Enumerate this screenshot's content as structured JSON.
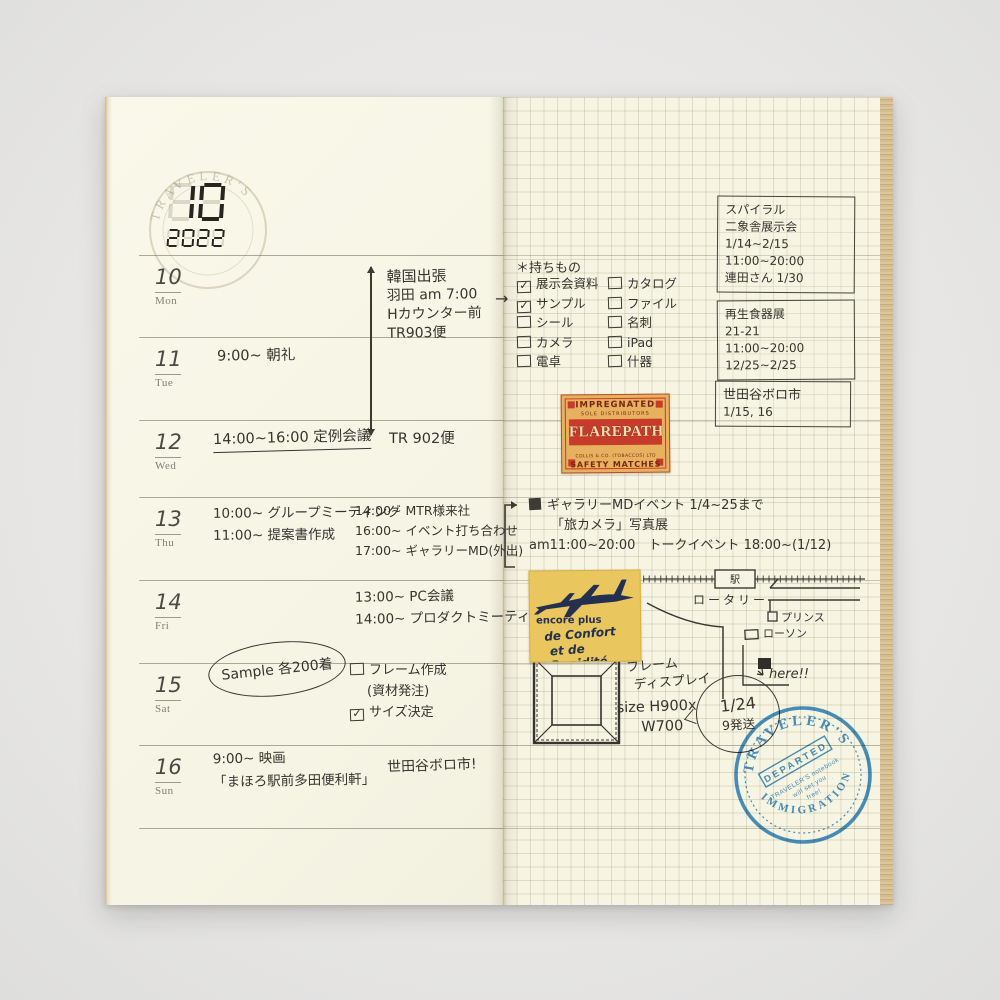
{
  "colors": {
    "ink": "#35342e",
    "printed_gray": "#80807a",
    "paper_left": "#f7f5e6",
    "paper_right": "#f6f4e3",
    "stamp_blue": "#2f83c5",
    "match_bg": "#e7b25f",
    "match_red": "#c63b2a",
    "sticker_yellow": "#eac75e",
    "sticker_navy": "#233050"
  },
  "header": {
    "month": "10",
    "year": "2022",
    "watermark": "TRAVELER'S"
  },
  "week": [
    {
      "date": "10",
      "day": "Mon",
      "plan": [
        "韓国出張",
        "羽田 am 7:00",
        "Hカウンター前",
        "TR903便"
      ],
      "arrow_note": "TR 902便"
    },
    {
      "date": "11",
      "day": "Tue",
      "plan": [
        "9:00~ 朝礼"
      ]
    },
    {
      "date": "12",
      "day": "Wed",
      "plan": [
        "14:00~16:00 定例会議"
      ]
    },
    {
      "date": "13",
      "day": "Thu",
      "plan": [
        "10:00~ グループミーティング",
        "11:00~ 提案書作成"
      ],
      "plan2": [
        "14:00~ MTR様来社",
        "16:00~ イベント打ち合わせ",
        "17:00~ ギャラリーMD(外出)"
      ]
    },
    {
      "date": "14",
      "day": "Fri",
      "plan2": [
        "13:00~ PC会議",
        "14:00~ プロダクトミーティング"
      ]
    },
    {
      "date": "15",
      "day": "Sat",
      "circled": "Sample 各200着",
      "tasks": [
        {
          "check": "",
          "label": "フレーム作成"
        },
        {
          "check": "",
          "label": "(資材発注)"
        },
        {
          "check": "✓",
          "label": "サイズ決定"
        }
      ]
    },
    {
      "date": "16",
      "day": "Sun",
      "plan": [
        "9:00~ 映画",
        "「まほろ駅前多田便利軒」"
      ],
      "note": "世田谷ボロ市!"
    }
  ],
  "memo": {
    "arrow": "→",
    "packing": {
      "title": "＊持ちもの",
      "col1": [
        {
          "check": "✓",
          "label": "展示会資料"
        },
        {
          "check": "✓",
          "label": "サンプル"
        },
        {
          "check": "",
          "label": "シール"
        },
        {
          "check": "",
          "label": "カメラ"
        },
        {
          "check": "",
          "label": "電卓"
        }
      ],
      "col2": [
        {
          "check": "",
          "label": "カタログ"
        },
        {
          "check": "",
          "label": "ファイル"
        },
        {
          "check": "",
          "label": "名刺"
        },
        {
          "check": "",
          "label": "iPad"
        },
        {
          "check": "",
          "label": "什器"
        }
      ]
    },
    "boxes": [
      {
        "lines": [
          "スパイラル",
          "二象舎展示会",
          "1/14~2/15",
          "11:00~20:00",
          "連田さん 1/30"
        ]
      },
      {
        "lines": [
          "再生食器展",
          "21-21",
          "11:00~20:00",
          "12/25~2/25"
        ]
      },
      {
        "lines": [
          "世田谷ボロ市",
          "1/15, 16"
        ]
      }
    ],
    "gallery": {
      "line1": "ギャラリーMDイベント 1/4~25まで",
      "line2": "「旅カメラ」写真展",
      "line3": "am11:00~20:00　トークイベント 18:00~(1/12)"
    },
    "map": {
      "station": "駅",
      "rotary": "ロータリー",
      "prince": "プリンス",
      "lawson": "ローソン",
      "here": "here!!"
    },
    "frame": {
      "title1": "フレーム",
      "title2": "ディスプレイ",
      "size1": "size H900x",
      "size2": "W700",
      "bubble1": "1/24",
      "bubble2": "9発送"
    }
  },
  "stickers": {
    "matchbox": {
      "top": "IMPREGNATED",
      "distributors": "SOLE DISTRIBUTORS",
      "name": "FLAREPATH",
      "maker": "COLLIS & CO. (TOBACCOS) LTD",
      "bottom": "SAFETY MATCHES"
    },
    "airline": {
      "line1": "encore plus",
      "line2": "de Confort",
      "line3": "et de Rapidité"
    }
  },
  "stamp": {
    "arc_top": "TRAVELER'S",
    "banner": "DEPARTED",
    "line1": "TRAVELER'S notebook",
    "line2": "will set you",
    "line3": "free!",
    "arc_bottom": "IMMIGRATION"
  }
}
